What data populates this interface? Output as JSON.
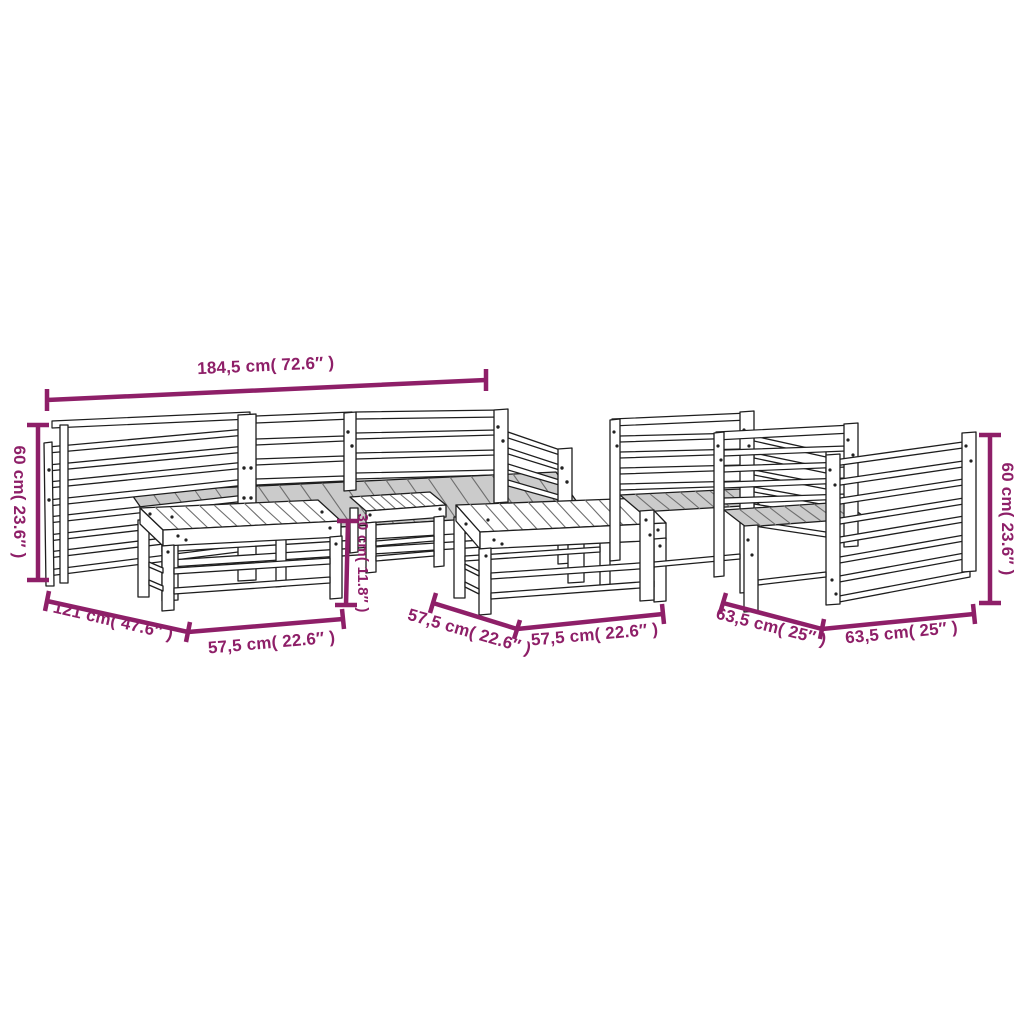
{
  "diagram_type": "product-dimension-diagram",
  "subject": "7-piece slatted wood garden lounge set line drawing",
  "colors": {
    "background": "#ffffff",
    "dimension_accent": "#8E1F68",
    "line_art": "#1e1e1e",
    "seat_shade": "#cbcbcb"
  },
  "dims": {
    "total_width": "184,5 cm( 72.6″ )",
    "left_height": "60 cm( 23.6″ )",
    "right_height": "60 cm( 23.6″ )",
    "corner_depth": "121 cm( 47.6″ )",
    "footstool_width_left": "57,5 cm( 22.6″ )",
    "footstool_depth_center": "57,5 cm( 22.6″ )",
    "footstool_width_center": "57,5 cm( 22.6″ )",
    "footstool_height": "30 cm( 11.8″ )",
    "chair_depth": "63,5 cm( 25″ )",
    "chair_width": "63,5 cm( 25″ )"
  }
}
